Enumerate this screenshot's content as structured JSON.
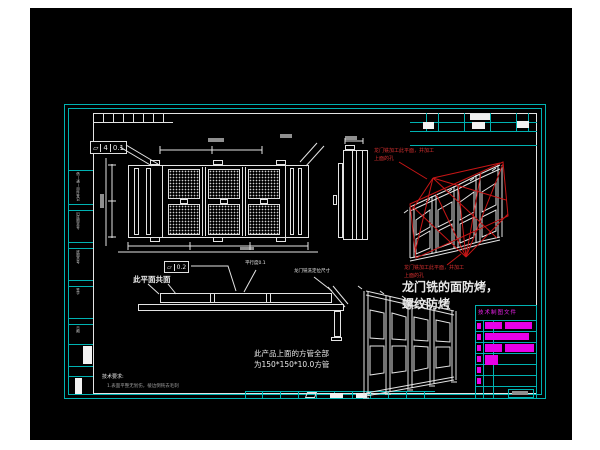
{
  "colors": {
    "frame_teal": "#00b2b2",
    "line_white": "#e4e4e4",
    "annotation_red": "#c81616",
    "highlight_magenta": "#e800e8",
    "canvas_black": "#000000",
    "page_white": "#ffffff"
  },
  "gdt_frame_top": {
    "symbol": "▱",
    "qty": "4",
    "tolerance": "0.1"
  },
  "gdt_frame_side": {
    "symbol": "▱",
    "tolerance": "0.2"
  },
  "annotations": {
    "coplanar_label": "此平面共面",
    "parallelism_label": "平行度0.1",
    "gantry_mill_position_label": "龙门铣洗定位尺寸",
    "red_note_upper_line1": "龙门铣加工此平面，并加工",
    "red_note_upper_line2": "上面的孔",
    "red_note_lower_line1": "龙门铣加工此平面，并加工",
    "red_note_lower_line2": "上面的孔",
    "mill_face_note_line1": "龙门铣的面防烤，",
    "mill_face_note_line2": "螺纹防烤",
    "square_tube_note_line1": "此产品上面的方管全部",
    "square_tube_note_line2": "为150*150*10.0方管"
  },
  "tech_requirements": {
    "title": "技术要求:",
    "line1": "1.表面平整无划伤，棱边倒钝去毛刺"
  },
  "border_margin": {
    "labels": [
      "借(通)用件登记",
      "旧底图总号",
      "底图总号",
      "签字",
      "日期"
    ]
  },
  "revision_table": {
    "header": "技术制图文件"
  }
}
